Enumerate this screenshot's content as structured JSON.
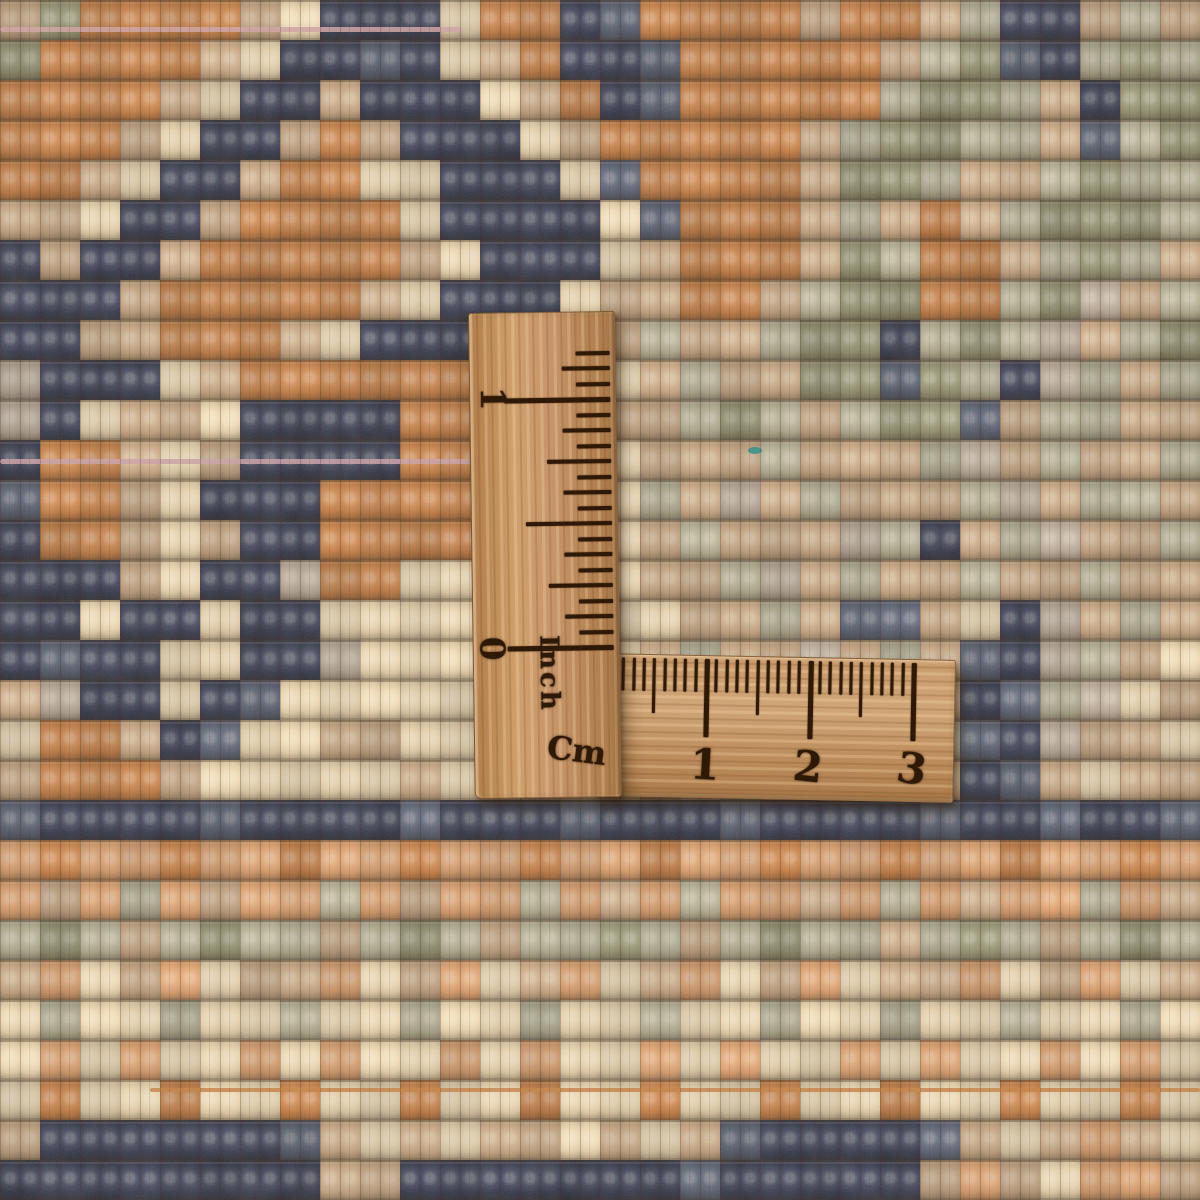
{
  "scene": {
    "description": "Close-up photo of the knotted back of a hand-woven wool rug with an L-shaped wooden folding ruler laid on top, showing centimetre and inch scales"
  },
  "rug": {
    "knot_size_px": 40,
    "palette": {
      "N": "#2b3147",
      "n": "#4d5569",
      "O": "#c0773c",
      "o": "#d89a66",
      "T": "#c3a27d",
      "t": "#b3a491",
      "C": "#e5d0a9",
      "G": "#8b8a68",
      "g": "#aaa689",
      "P": "#cfa6a4"
    },
    "pattern_rows": [
      "TGOOOOTCNNNCOONnOOOOTOOTgNNTgT",
      "GOOOOTCNNnNCTONNnOOOOOTgGnNgGg",
      "OOOOTCNNTNNNCTONnOOOOOgGGgTNGG",
      "OOOTCNNTOTNNNCTOOOOOTgGGggTngG",
      "OOTCNNTOOCCNNNCnOOOOTGGgTTgGgg",
      "TTCNNTOOOOCNNNNCnOOOTgTOTgGGGg",
      "NTNNTOOOOOTCNNNCTOOOTGgOOTgGgT",
      "NNNTOOOOOTCNNNCTTOOTgGGOOgGtTg",
      "NNTTOOOTCNNNCTTTgTTgGGNgGgtTgG",
      "tNNNCTOOOOOOCCCCTgTTGGnGgNtgTg",
      "tNCTTCNNNNOOCCCTTgGgTgGGnTggTT",
      "NOOTCTNNNNOOCCCCTTTgTTTgtTgTTg",
      "nOOTCNNNOOOOCCCCgTtTgTTTgtTggT",
      "NOOTCTNNOOOOCCCCTgTTTtgNTgtTTg",
      "NNNTCNNtOOCCCCCCTTgtTgTTgTTgTT",
      "NNCNNCNNCCCCCCCCCTTgTnnTCNtTgT",
      "NnNNCCNNtCCCCCCCTgTTtTgTnNtgTC",
      "TtNNCNnCCCCCTCCCTTgtTTgTNngtCT",
      "COOTNnCCTTCCCTCCCTTgTtTgnNtTTC",
      "TOOOTCCCCCTCCCCCTCgTTgtTNnTCTT",
      "nNNNNnNNNNnNNNnNNNnNNNNnNNnNNn",
      "oOooOooOooOooOooOooOooOooOooOo",
      "oTogoToogoToogoTogooTogoToogoT",
      "gGgTgGggTgGgTggGgTgGggTgGgTgGg",
      "ToCToCTToCToCToCToCToCTToCToCT",
      "CgCCgCCgCCgCCgCCgCCgCCgCCgCCgC",
      "CoCoCCoCoCCoCoCCoCoCCoCoCCoCoC",
      "COCCOCCOCCOCCOCCOCCOCCOCCOCCOC",
      "TNNNNNNnTCTCTTCTCTnNNNNnTCToTC",
      "NNNNNNNNTTNNNNNNNnNNNNNToTCooT"
    ],
    "weft_threads": [
      {
        "name": "pink-weft-top",
        "x": 0,
        "y": 27,
        "width": 462,
        "height": 5,
        "color": "#d2a3a3"
      },
      {
        "name": "pink-weft-middle",
        "x": 0,
        "y": 459,
        "width": 560,
        "height": 5,
        "color": "#cda0a6"
      },
      {
        "name": "orange-weft",
        "x": 150,
        "y": 1088,
        "width": 1050,
        "height": 4,
        "color": "#c8803f"
      }
    ],
    "flecks": [
      {
        "name": "teal-fiber",
        "x": 748,
        "y": 447,
        "width": 14,
        "height": 7,
        "color": "#2f8d86"
      }
    ]
  },
  "ruler": {
    "material": "wood",
    "burn_color": "#2e1806",
    "vertical_arm": {
      "unit_label": "Inch",
      "number_labels": [
        "0",
        "1"
      ],
      "ticks_per_inch": 16,
      "tick_count": 20
    },
    "horizontal_arm": {
      "unit_label": "Cm",
      "number_labels": [
        "0",
        "1",
        "2",
        "3"
      ],
      "ticks_per_cm": 10,
      "tick_count": 31
    }
  }
}
